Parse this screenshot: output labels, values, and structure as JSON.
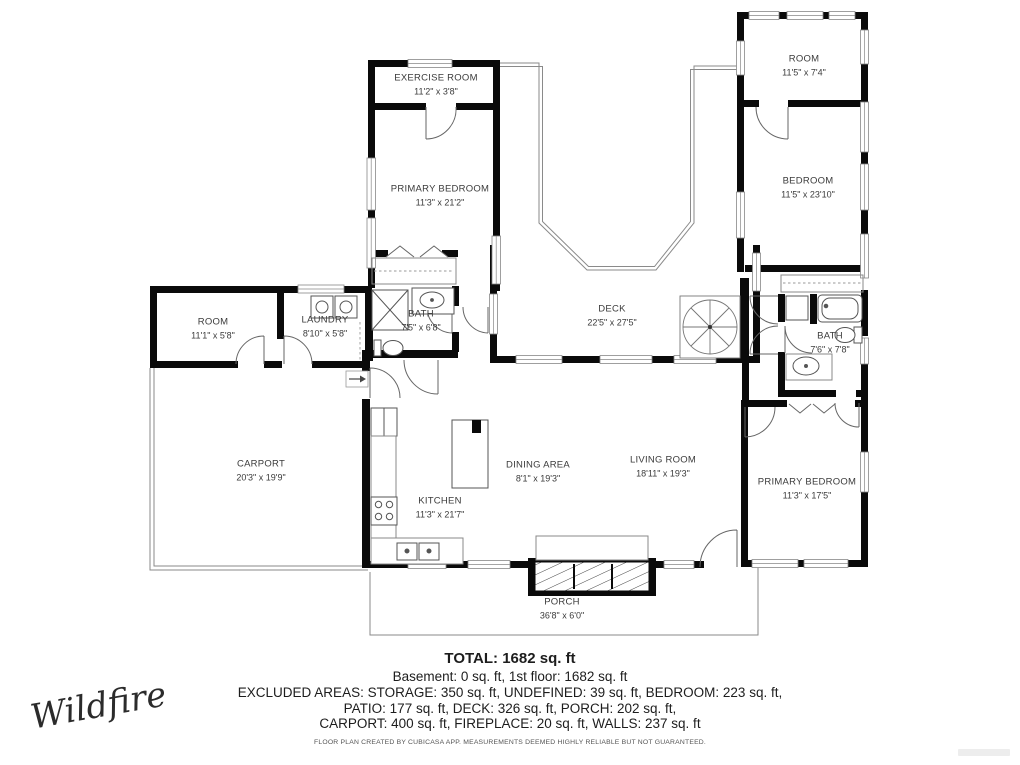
{
  "plan": {
    "rooms": {
      "exercise_room": {
        "name": "EXERCISE ROOM",
        "dims": "11'2\" x 3'8\""
      },
      "primary_bedroom_upper": {
        "name": "PRIMARY BEDROOM",
        "dims": "11'3\" x 21'2\""
      },
      "room_top_right": {
        "name": "ROOM",
        "dims": "11'5\" x 7'4\""
      },
      "bedroom_right": {
        "name": "BEDROOM",
        "dims": "11'5\" x 23'10\""
      },
      "room_left": {
        "name": "ROOM",
        "dims": "11'1\" x 5'8\""
      },
      "laundry": {
        "name": "LAUNDRY",
        "dims": "8'10\" x 5'8\""
      },
      "bath_center": {
        "name": "BATH",
        "dims": "7'5\" x 6'8\""
      },
      "deck": {
        "name": "DECK",
        "dims": "22'5\" x 27'5\""
      },
      "bath_right": {
        "name": "BATH",
        "dims": "7'6\" x 7'8\""
      },
      "carport": {
        "name": "CARPORT",
        "dims": "20'3\" x 19'9\""
      },
      "kitchen": {
        "name": "KITCHEN",
        "dims": "11'3\" x 21'7\""
      },
      "dining_area": {
        "name": "DINING AREA",
        "dims": "8'1\" x 19'3\""
      },
      "living_room": {
        "name": "LIVING ROOM",
        "dims": "18'11\" x 19'3\""
      },
      "primary_bedroom_lower": {
        "name": "PRIMARY BEDROOM",
        "dims": "11'3\" x 17'5\""
      },
      "porch": {
        "name": "PORCH",
        "dims": "36'8\" x 6'0\""
      }
    },
    "summary": {
      "total": "TOTAL: 1682 sq. ft",
      "line1": "Basement: 0 sq. ft, 1st floor: 1682 sq. ft",
      "line2": "EXCLUDED AREAS: STORAGE: 350 sq. ft, UNDEFINED: 39 sq. ft, BEDROOM: 223 sq. ft,",
      "line3": "PATIO: 177 sq. ft, DECK: 326 sq. ft, PORCH: 202 sq. ft,",
      "line4": "CARPORT: 400 sq. ft, FIREPLACE: 20 sq. ft, WALLS: 237 sq. ft"
    },
    "disclaimer": "FLOOR PLAN CREATED BY CUBICASA APP. MEASUREMENTS DEEMED HIGHLY RELIABLE BUT NOT GUARANTEED.",
    "branding": {
      "logo": "Wildfire"
    },
    "colors": {
      "wall": "#0a0a0a",
      "thin_line": "#888888",
      "text": "#3b3b3b"
    }
  }
}
